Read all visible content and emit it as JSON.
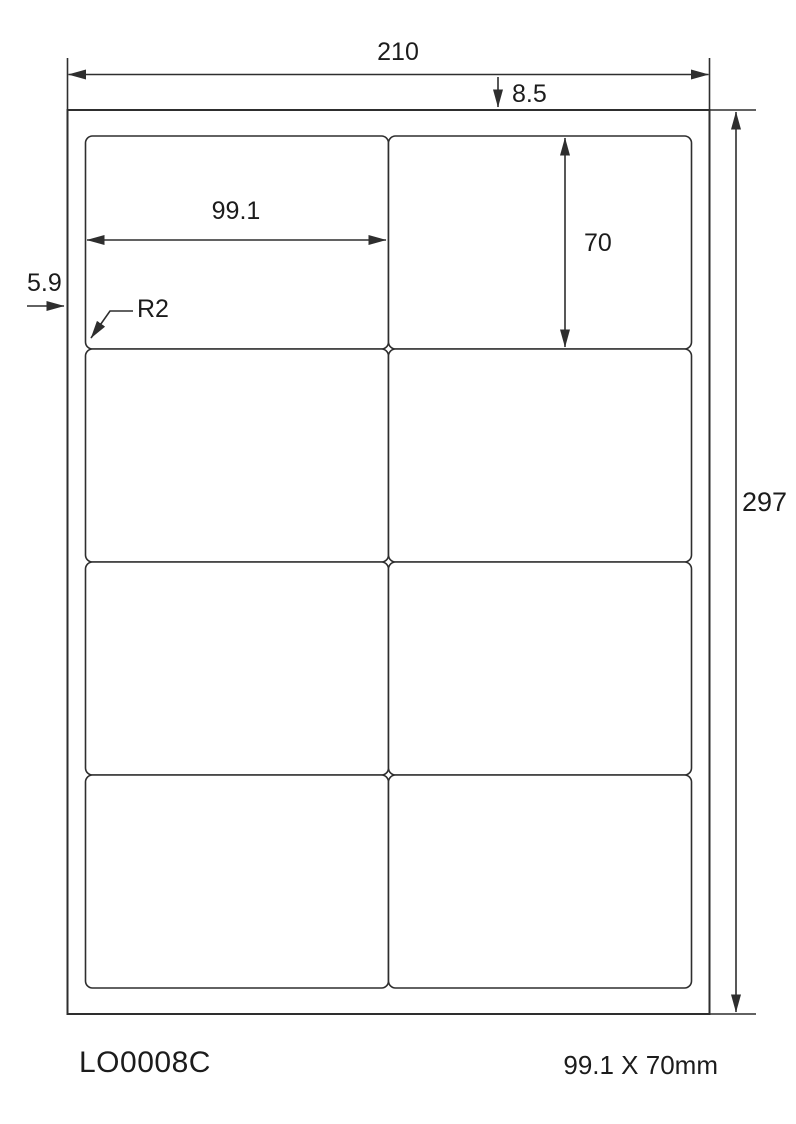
{
  "diagram": {
    "product_code": "LO0008C",
    "label_size_text": "99.1 X 70mm",
    "dimensions": {
      "page_width": "210",
      "page_height": "297",
      "top_margin": "8.5",
      "side_margin": "5.9",
      "label_width": "99.1",
      "label_height": "70",
      "corner_radius": "R2"
    },
    "grid": {
      "rows": 4,
      "columns": 2
    },
    "geometry": {
      "label_origin_x": 85.5,
      "label_origin_y": 136,
      "cell_width": 303,
      "cell_height": 213,
      "cell_corner_radius": 7
    },
    "colors": {
      "line": "#2e2e2e",
      "text": "#1c1c1c",
      "background": "#ffffff"
    }
  }
}
